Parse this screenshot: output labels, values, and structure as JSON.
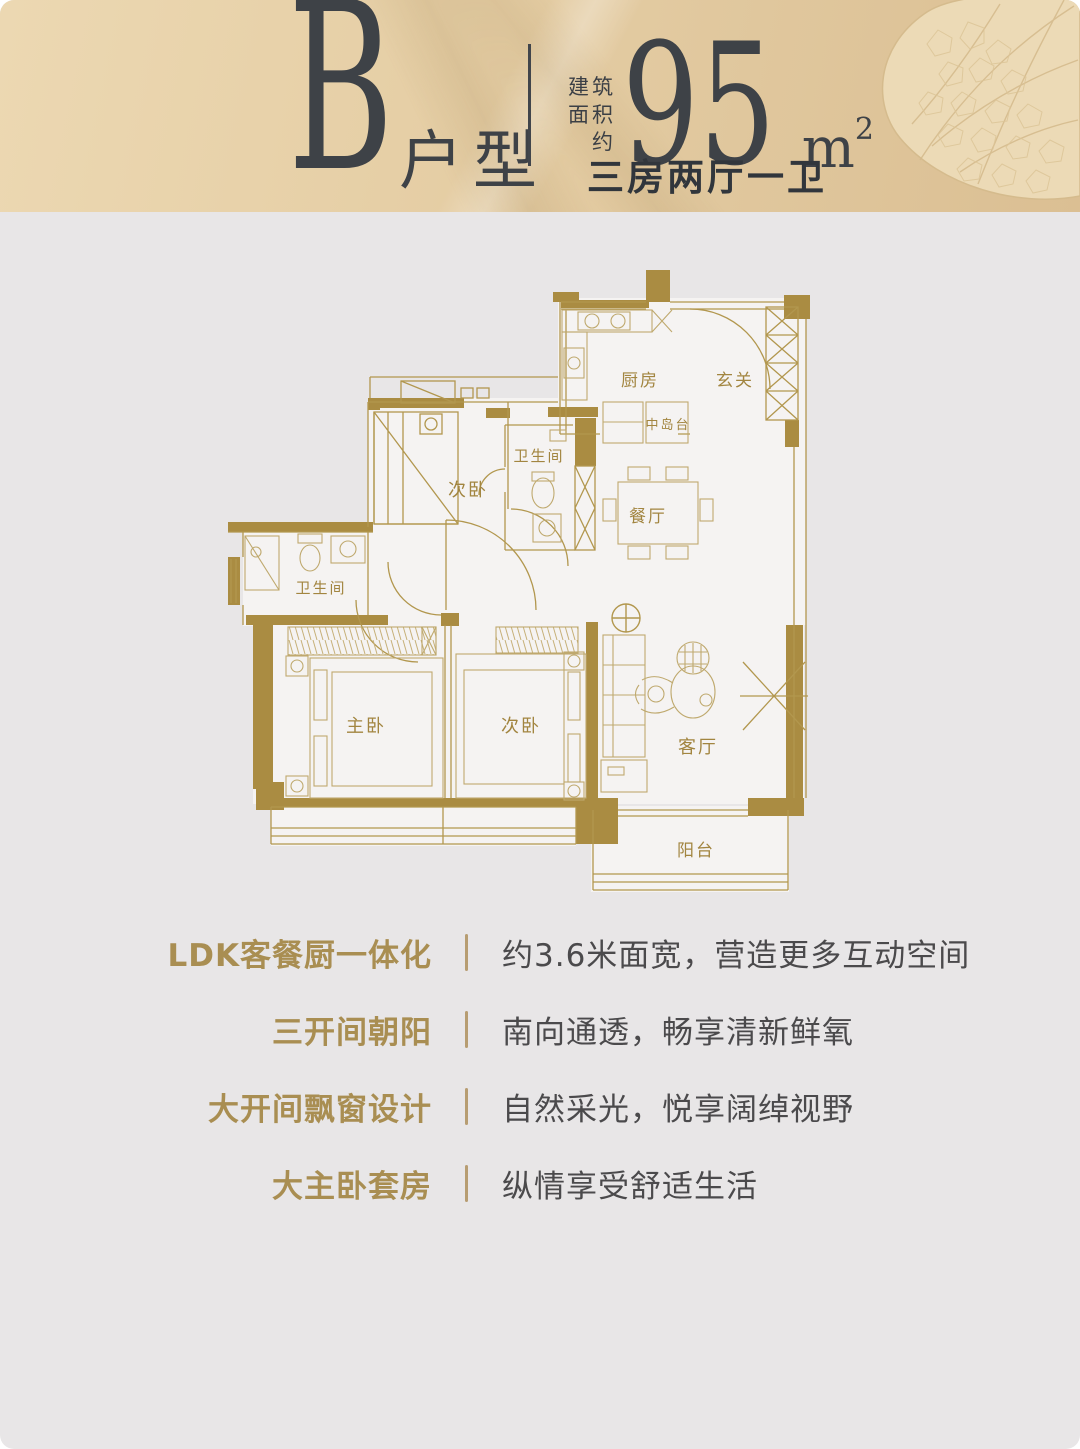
{
  "header": {
    "type_letter": "B",
    "type_label": "户型",
    "area_prefix_lines": [
      "建筑",
      "面积",
      "约"
    ],
    "area_value": "95",
    "area_unit": "m",
    "area_unit_sup": "2",
    "layout_summary": "三房两厅一卫"
  },
  "floorplan": {
    "rooms": {
      "kitchen": "厨房",
      "entry": "玄关",
      "island": "中岛台",
      "bath_upper": "卫生间",
      "bedroom_upper": "次卧",
      "dining": "餐厅",
      "bath_left": "卫生间",
      "master": "主卧",
      "bedroom_lower": "次卧",
      "living": "客厅",
      "balcony": "阳台"
    }
  },
  "features": [
    {
      "title": "LDK客餐厨一体化",
      "desc": "约3.6米面宽，营造更多互动空间"
    },
    {
      "title": "三开间朝阳",
      "desc": "南向通透，畅享清新鲜氧"
    },
    {
      "title": "大开间飘窗设计",
      "desc": "自然采光，悦享阔绰视野"
    },
    {
      "title": "大主卧套房",
      "desc": "纵情享受舒适生活"
    }
  ],
  "colors": {
    "header_bg": "#e2c89e",
    "page_bg": "#e8e6e7",
    "wall_gold": "#aa8c42",
    "plan_line_gold": "#b2974e",
    "plan_label_gold": "#a28540",
    "feature_title_gold": "#a98e52",
    "feature_divider": "#b79d72",
    "dark_text": "#3e4247",
    "desc_text": "#4b4a4c"
  }
}
